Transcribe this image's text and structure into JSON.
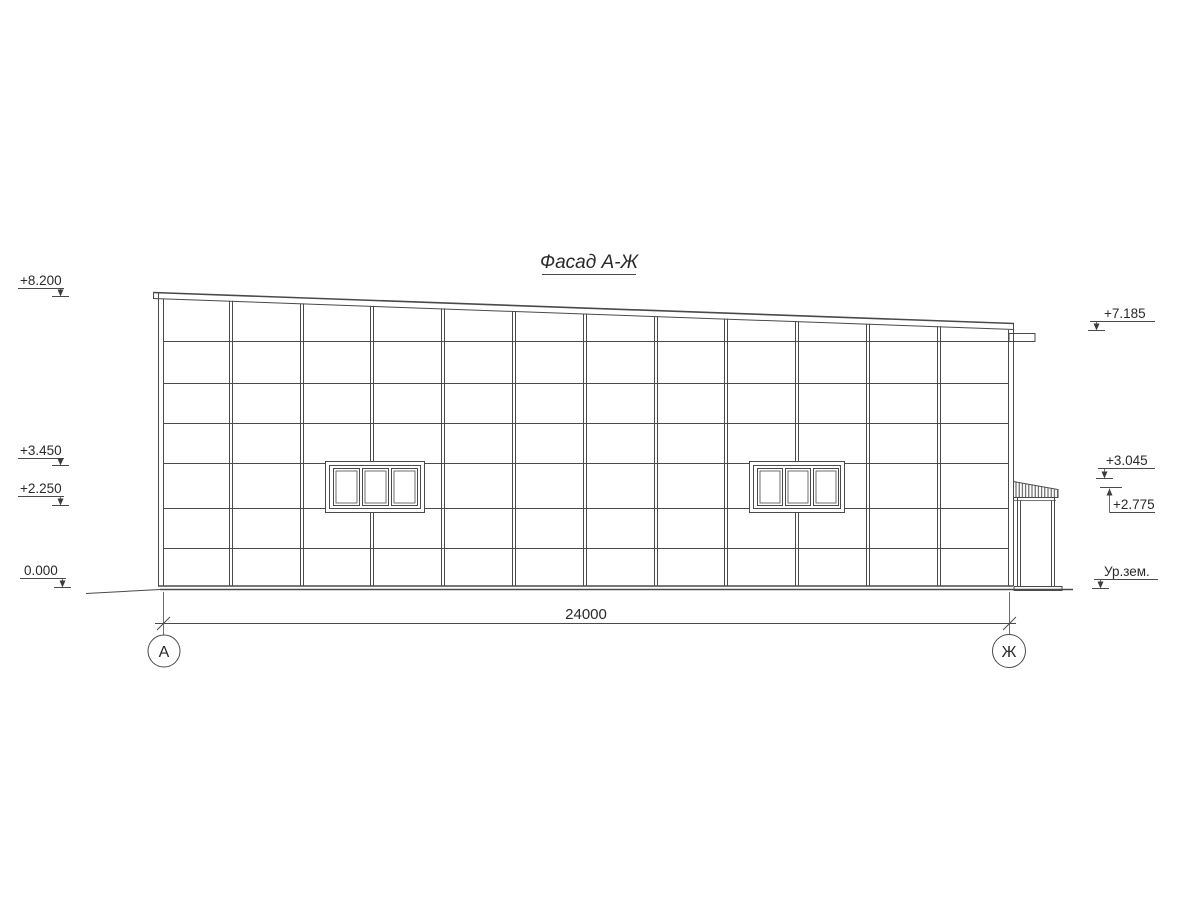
{
  "title": "Фасад А-Ж",
  "elevations": {
    "left": [
      {
        "label": "+8.200"
      },
      {
        "label": "+3.450"
      },
      {
        "label": "+2.250"
      },
      {
        "label": "0.000"
      }
    ],
    "right": [
      {
        "label": "+7.185"
      },
      {
        "label": "+3.045"
      },
      {
        "label": "+2.775"
      },
      {
        "label": "Ур.зем."
      }
    ]
  },
  "dimension": {
    "length_label": "24000"
  },
  "axes": {
    "left_label": "А",
    "right_label": "Ж"
  },
  "colors": {
    "line": "#4a4a4a",
    "text": "#2a2a2a",
    "background": "#ffffff"
  }
}
